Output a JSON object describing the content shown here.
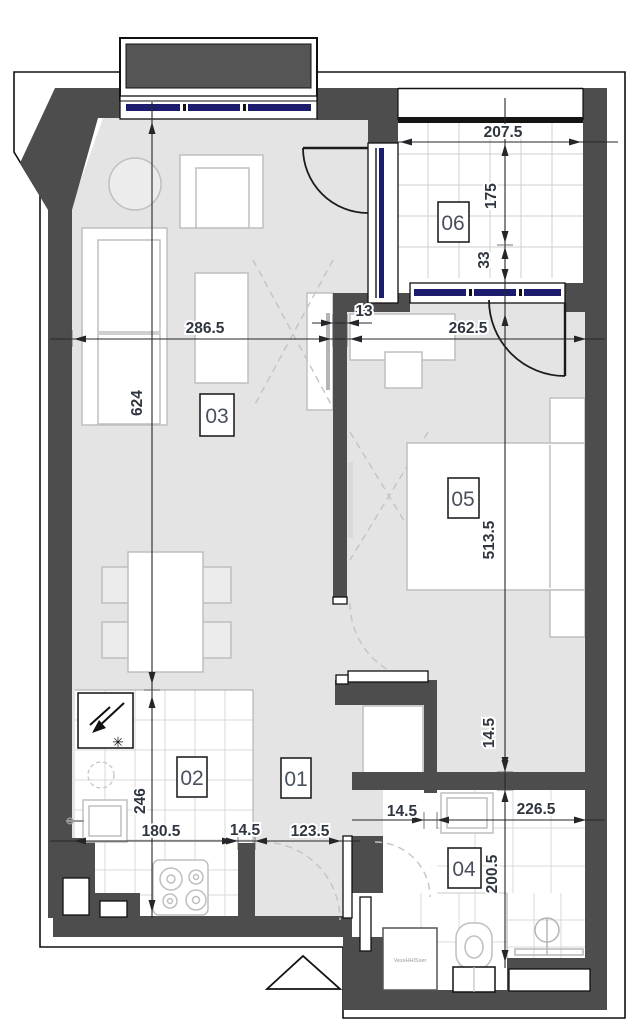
{
  "drawing": {
    "type": "apartment-floor-plan"
  },
  "colors": {
    "wall": "#4d4d4d",
    "floor": "#e4e4e4",
    "tile_grid": "#cfcfcf",
    "glazing_blue": "#1c1c6e",
    "railing_black": "#141414",
    "outline": "#111111",
    "dim_text": "#2f3640"
  },
  "rooms": [
    {
      "number": "01"
    },
    {
      "number": "02"
    },
    {
      "number": "03"
    },
    {
      "number": "04"
    },
    {
      "number": "05"
    },
    {
      "number": "06"
    }
  ],
  "dims": {
    "living_width": "286.5",
    "living_height": "624",
    "partition_thickness": "13",
    "balcony_width": "207.5",
    "balcony_depth": "175",
    "balcony_offset": "33",
    "bedroom_width": "262.5",
    "bedroom_height": "513.5",
    "bedroom_wall": "14.5",
    "bath_wall": "14.5",
    "bath_width": "226.5",
    "bath_height": "200.5",
    "kitchen_height": "246",
    "kitchen_width": "180.5",
    "entrance_jamb": "14.5",
    "hall_width": "123.5"
  },
  "appliances": {
    "washer_label": "VessHHISser"
  }
}
